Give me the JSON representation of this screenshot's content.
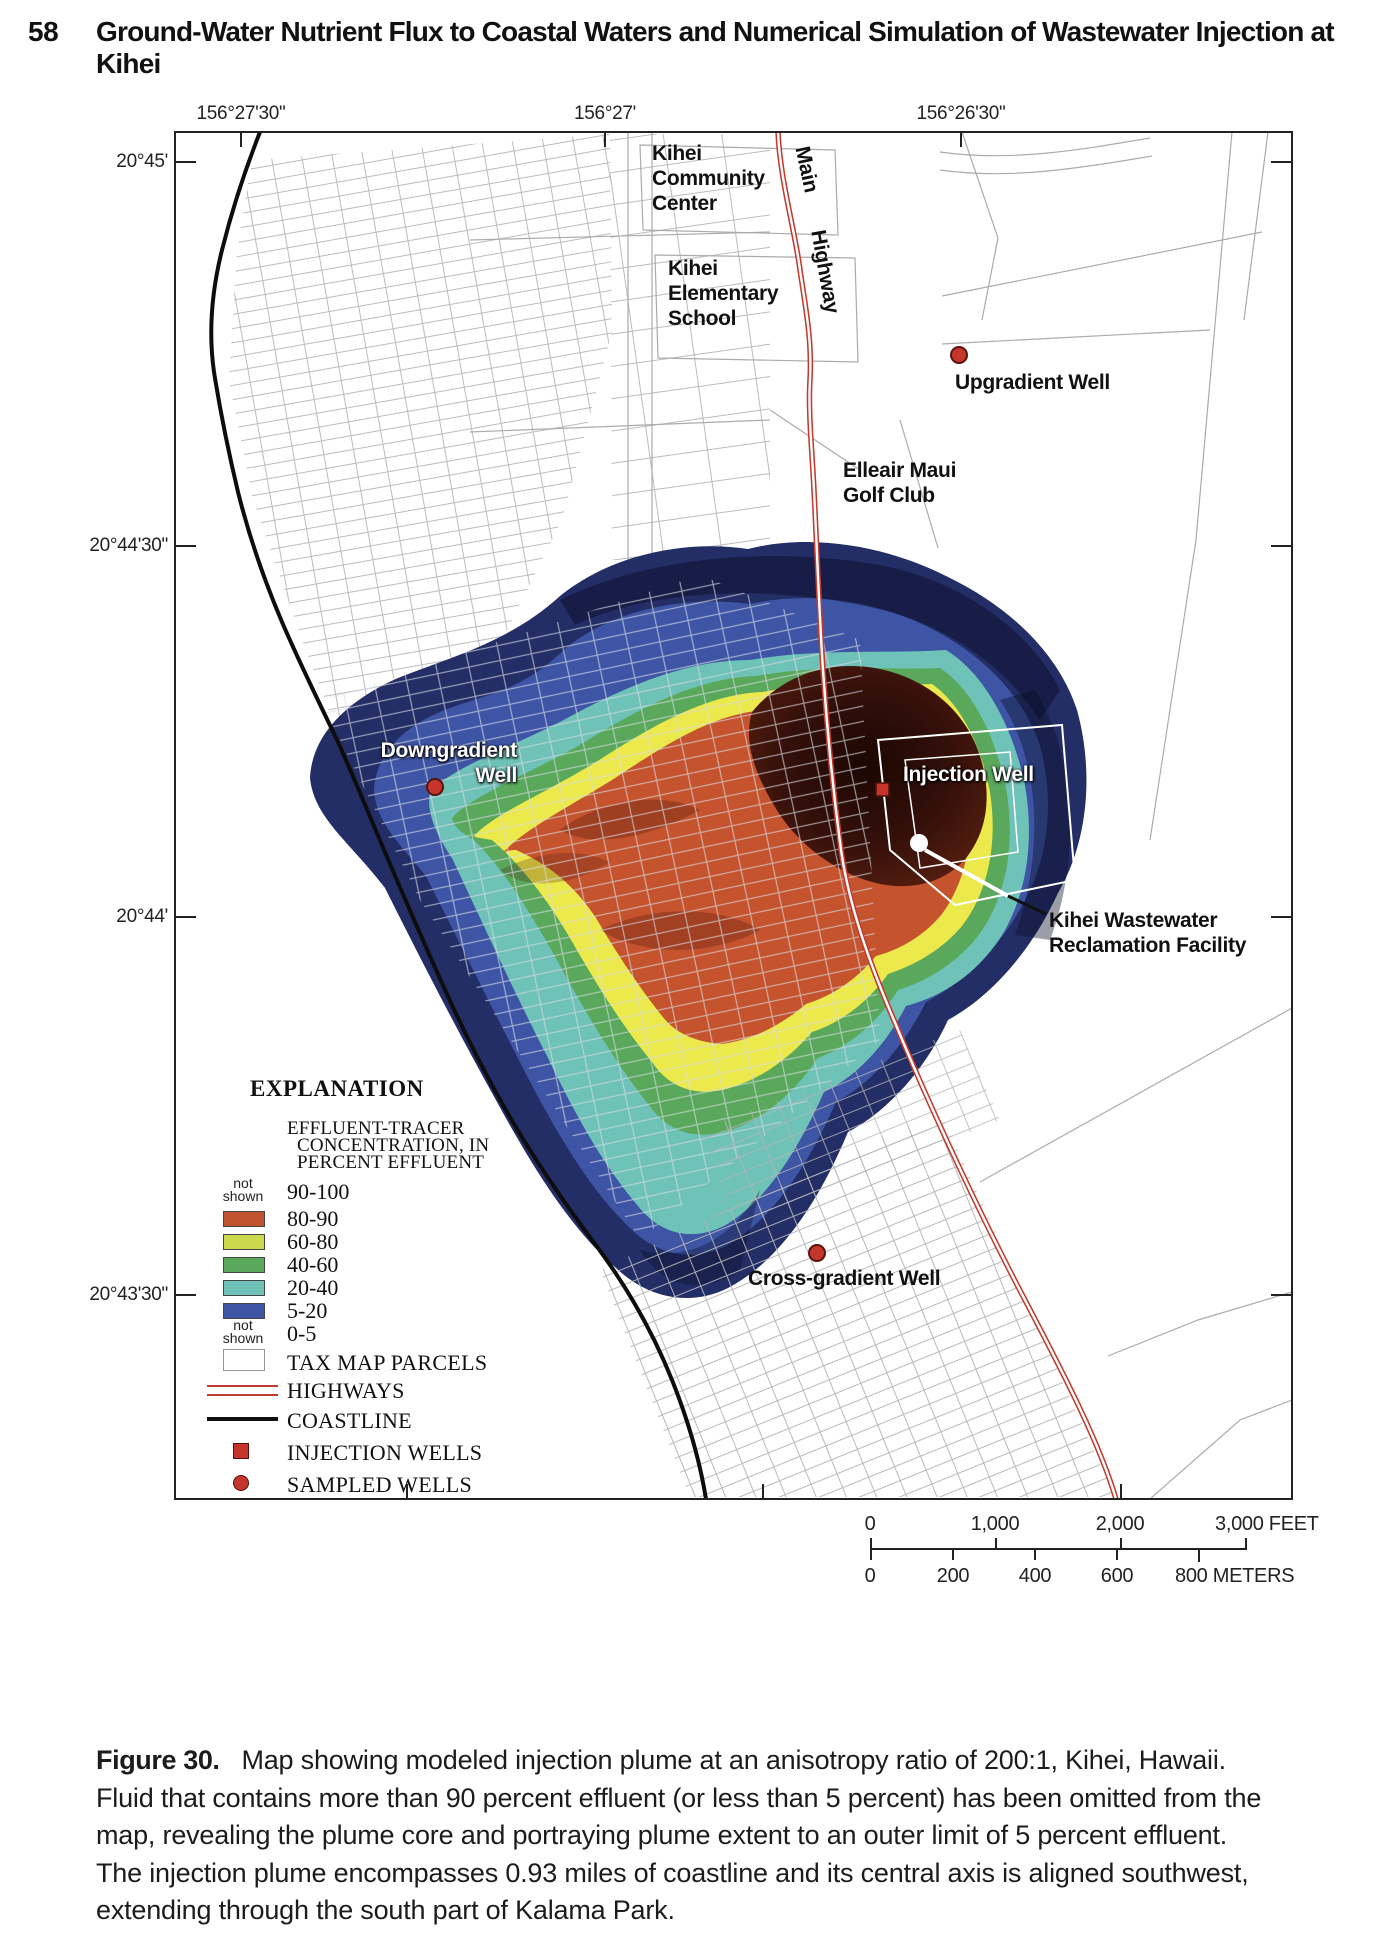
{
  "page": {
    "number": "58",
    "running_title": "Ground-Water Nutrient Flux to Coastal Waters and Numerical Simulation of Wastewater Injection at Kihei"
  },
  "map": {
    "coords_top": [
      "156°27'30\"",
      "156°27'",
      "156°26'30\""
    ],
    "coords_left": [
      "20°45'",
      "20°44'30\"",
      "20°44'",
      "20°43'30\""
    ],
    "places": {
      "community_center": [
        "Kihei",
        "Community",
        "Center"
      ],
      "elementary_school": [
        "Kihei",
        "Elementary",
        "School"
      ],
      "golf_club": [
        "Elleair Maui",
        "Golf Club"
      ],
      "highway_word1": "Main",
      "highway_word2": "Highway",
      "kwrf": [
        "Kihei Wastewater",
        "Reclamation Facility"
      ]
    },
    "wells": {
      "upgradient": "Upgradient Well",
      "downgradient": [
        "Downgradient",
        "Well"
      ],
      "injection": "Injection Well",
      "cross_gradient": "Cross-gradient Well"
    }
  },
  "legend": {
    "title": "EXPLANATION",
    "subtitle": [
      "EFFLUENT-TRACER",
      "CONCENTRATION, IN",
      "PERCENT EFFLUENT"
    ],
    "not_shown": [
      "not",
      "shown"
    ],
    "concentration_rows": [
      {
        "swatch": "none",
        "label": "90-100"
      },
      {
        "swatch": "#c0532f",
        "label": "80-90"
      },
      {
        "swatch": "#ccd94c",
        "label": "60-80"
      },
      {
        "swatch": "#5aa85c",
        "label": "40-60"
      },
      {
        "swatch": "#6fc2b8",
        "label": "20-40"
      },
      {
        "swatch": "#3e55a5",
        "label": "5-20"
      },
      {
        "swatch": "none",
        "label": "0-5"
      }
    ],
    "symbol_rows": [
      {
        "symbol": "tax-map-parcel",
        "label": "TAX MAP PARCELS"
      },
      {
        "symbol": "highway",
        "label": "HIGHWAYS"
      },
      {
        "symbol": "coastline",
        "label": "COASTLINE"
      },
      {
        "symbol": "injection-well",
        "label": "INJECTION WELLS"
      },
      {
        "symbol": "sampled-well",
        "label": "SAMPLED WELLS"
      }
    ]
  },
  "scale_bar": {
    "feet_labels": [
      "0",
      "1,000",
      "2,000",
      "3,000 FEET"
    ],
    "meter_labels": [
      "0",
      "200",
      "400",
      "600",
      "800 METERS"
    ]
  },
  "caption": {
    "label": "Figure 30.",
    "lines": [
      "Map showing modeled injection plume at an anisotropy ratio of 200:1, Kihei, Hawaii.",
      "Fluid that contains more than 90 percent effluent (or less than 5 percent) has been omitted from the",
      "map, revealing the plume core and portraying plume extent to an outer limit of 5 percent effluent.",
      "The injection plume encompasses 0.93 miles of coastline and its central axis is aligned southwest,",
      "extending through the south part of Kalama Park."
    ]
  },
  "colors": {
    "plume_outer_navy": "#232d66",
    "plume_blue_5_20": "#3e55a5",
    "plume_teal_20_40": "#6fc2b8",
    "plume_green_40_60": "#5aa85c",
    "plume_yellow_60_80": "#ece94c",
    "plume_orange_80_90": "#c5532e",
    "plume_core_dark": "#2f0e06",
    "highway_red": "#c23b2f",
    "well_red": "#c4362c",
    "parcel_gray": "#adafb2",
    "coastline_black": "#0d0d0d"
  }
}
